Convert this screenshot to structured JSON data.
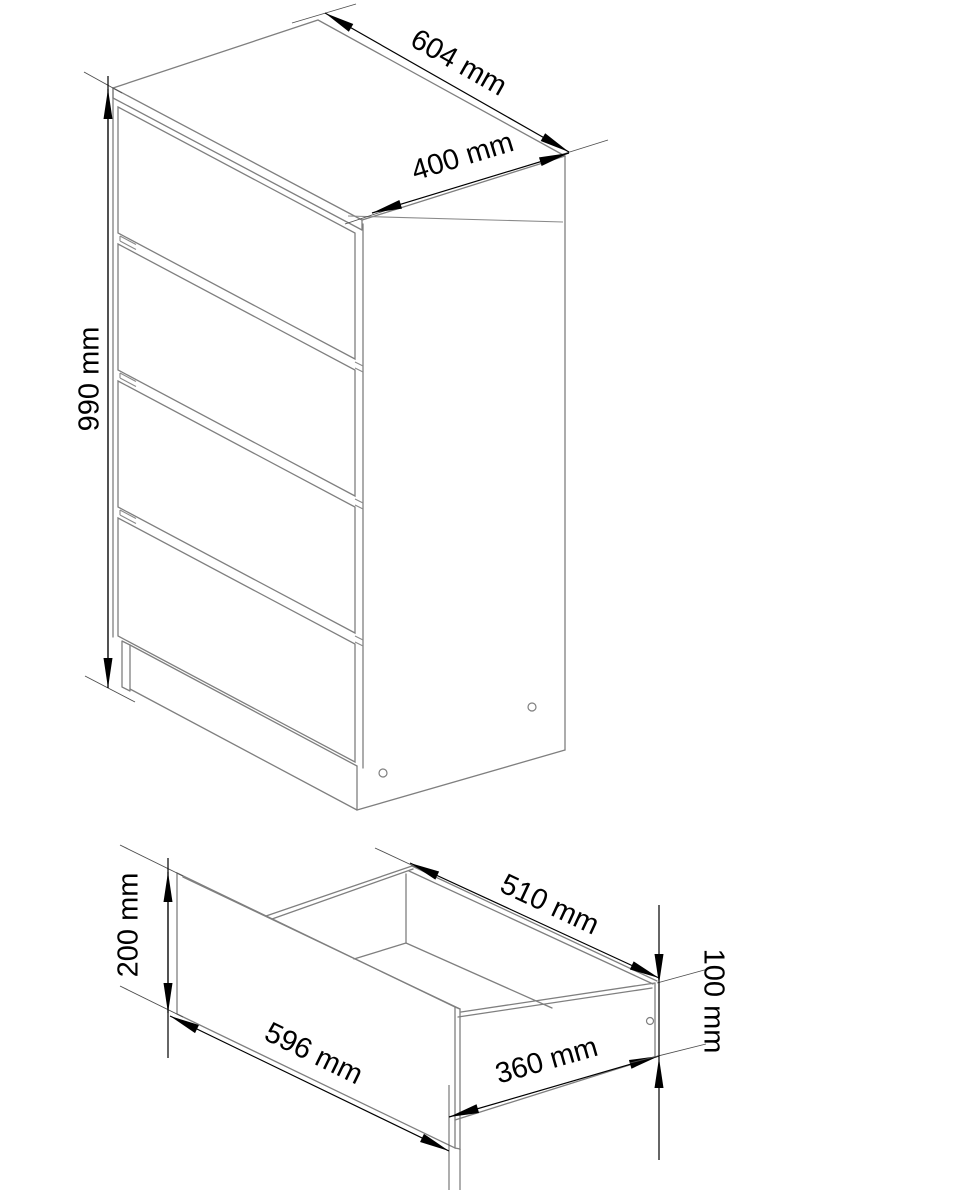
{
  "page": {
    "type": "furniture dimension diagram",
    "background": "#ffffff"
  },
  "colors": {
    "object_line": "#7f7f7f",
    "dimension_line": "#000000",
    "label_text": "#000000",
    "background": "#ffffff"
  },
  "views": [
    {
      "name": "chest-of-drawers-isometric-view",
      "drawer_count": 4,
      "dimensions": [
        {
          "label": "604 mm",
          "value": 604,
          "unit": "mm",
          "measures": "top width"
        },
        {
          "label": "400 mm",
          "value": 400,
          "unit": "mm",
          "measures": "top depth"
        },
        {
          "label": "990 mm",
          "value": 990,
          "unit": "mm",
          "measures": "overall height"
        }
      ]
    },
    {
      "name": "drawer-isometric-view",
      "dimensions": [
        {
          "label": "200 mm",
          "value": 200,
          "unit": "mm",
          "measures": "drawer front height"
        },
        {
          "label": "596 mm",
          "value": 596,
          "unit": "mm",
          "measures": "drawer front width"
        },
        {
          "label": "510 mm",
          "value": 510,
          "unit": "mm",
          "measures": "drawer inner width at back"
        },
        {
          "label": "360 mm",
          "value": 360,
          "unit": "mm",
          "measures": "drawer side depth"
        },
        {
          "label": "100 mm",
          "value": 100,
          "unit": "mm",
          "measures": "drawer side height"
        }
      ]
    }
  ]
}
